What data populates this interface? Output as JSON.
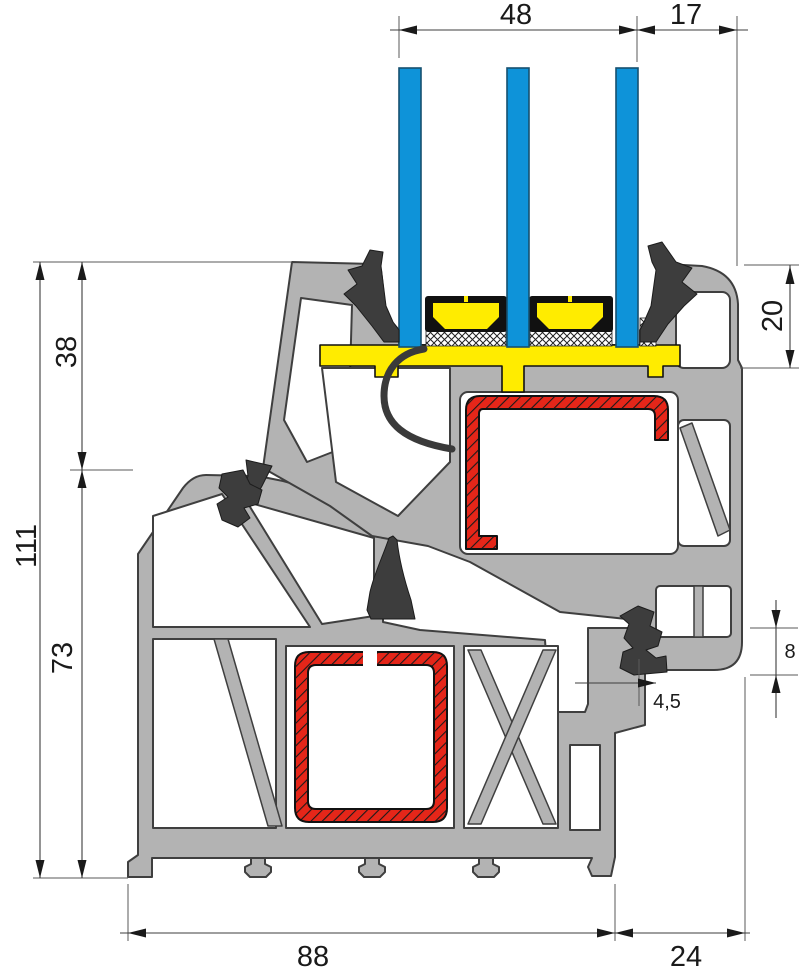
{
  "figure": {
    "type": "technical-cross-section",
    "subject": "PVC window frame and sash profile section with triple glazing"
  },
  "colors": {
    "profile_gray": "#b3b3b3",
    "outline": "#3f3f3f",
    "glass_blue": "#0e93d9",
    "glazing_yellow": "#ffec00",
    "steel_red": "#e52619",
    "gasket_dark": "#3d3d3d"
  },
  "dimensions": {
    "top": {
      "glazing_width": "48",
      "edge_offset": "17"
    },
    "left": {
      "upper": "38",
      "total": "111",
      "lower": "73"
    },
    "right": {
      "cover_height": "20",
      "overlap": "8",
      "clearance": "4,5"
    },
    "bottom": {
      "frame_depth": "88",
      "sash_overhang": "24"
    }
  }
}
